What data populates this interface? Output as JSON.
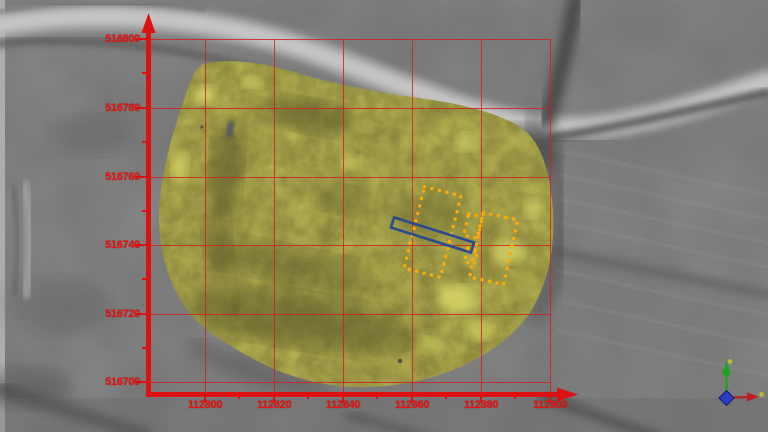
{
  "map": {
    "x_axis": {
      "ticks": [
        "112800",
        "112820",
        "112840",
        "112860",
        "112880",
        "112900"
      ]
    },
    "y_axis": {
      "ticks": [
        "516800",
        "516780",
        "516760",
        "516740",
        "516720",
        "516700"
      ]
    },
    "axis_color": "#dc1212",
    "grid_color": "#ce2020",
    "label_color": "#ea1111"
  },
  "overlays": {
    "survey_overlay_color": "#a19c41",
    "dashed_interpretation_color": "#ffab07",
    "solid_interpretation_color": "#2b4a8f"
  },
  "gizmo": {
    "up_axis_color": "#1da21d",
    "right_axis_color": "#c01c1c",
    "origin_color": "#2b3bc4",
    "tip_marker_color": "#b9bc2e"
  }
}
